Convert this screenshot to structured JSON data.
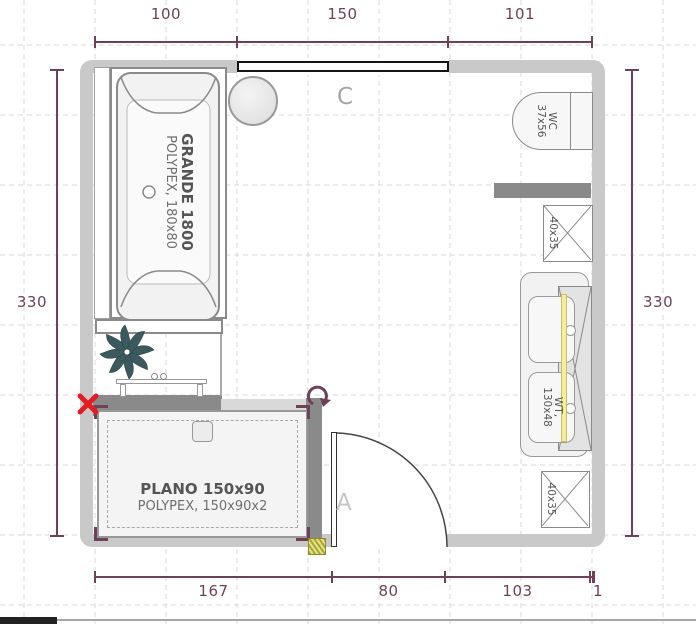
{
  "plan_title": "bathroom-floor-plan",
  "dims": {
    "top": [
      "100",
      "150",
      "101"
    ],
    "bottom": [
      "167",
      "80",
      "103",
      "1"
    ],
    "left": "330",
    "right": "330"
  },
  "fixtures": {
    "bathtub": {
      "name": "GRANDE 1800",
      "spec": "POLYPEX, 180x80"
    },
    "shower": {
      "name": "PLANO 150x90",
      "spec": "POLYPEX, 150x90x2"
    },
    "wc": {
      "name": "WC",
      "size": "37x56"
    },
    "washtable": {
      "name": "WT,",
      "size": "130x48"
    },
    "cabinet_upper": {
      "size": "40x35"
    },
    "cabinet_lower": {
      "size": "40x35"
    }
  },
  "labels": {
    "window": "C",
    "door": "A"
  },
  "icons": {
    "delete": "red-x-icon",
    "rotate": "rotate-cw-icon",
    "plant": "plant-icon"
  },
  "colors": {
    "dimension": "#6d4158",
    "wall": "#c9c9c9",
    "partition": "#8a8a8a",
    "accent_red": "#e31b23",
    "plant": "#3c5a5e",
    "mirror_strip": "#f2ee9d",
    "hatch_square": "#a8a833"
  }
}
